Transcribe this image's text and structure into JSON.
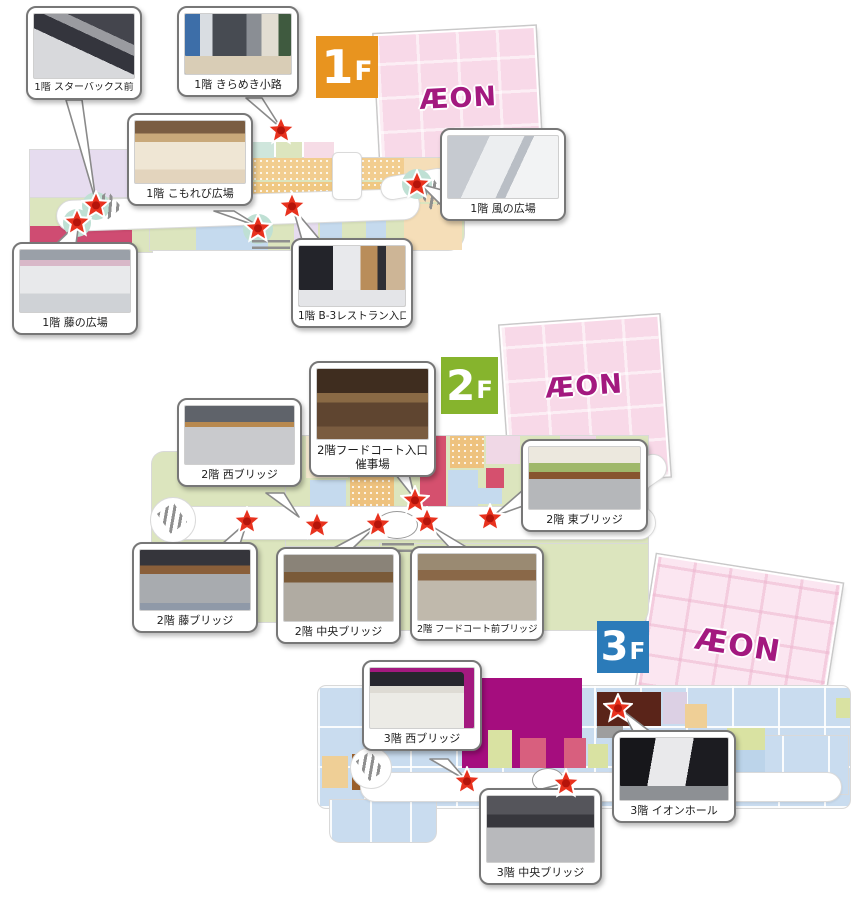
{
  "floors": [
    {
      "name": "1F",
      "badge": {
        "number": "1",
        "suffix": "F"
      },
      "aeon_logo": "ÆON",
      "callouts": [
        {
          "id": "starbucks",
          "label": "1階 スターバックス前"
        },
        {
          "id": "kirameki",
          "label": "1階 きらめき小路"
        },
        {
          "id": "komorebi",
          "label": "1階 こもれび広場"
        },
        {
          "id": "kaze",
          "label": "1階 風の広場"
        },
        {
          "id": "fuji",
          "label": "1階 藤の広場"
        },
        {
          "id": "b3",
          "label": "1階 B-3レストラン入口"
        }
      ]
    },
    {
      "name": "2F",
      "badge": {
        "number": "2",
        "suffix": "F"
      },
      "aeon_logo": "ÆON",
      "callouts": [
        {
          "id": "nishi",
          "label": "2階 西ブリッジ"
        },
        {
          "id": "foodcourt_entrance",
          "label": "2階フードコート入口催事場"
        },
        {
          "id": "higashi",
          "label": "2階 東ブリッジ"
        },
        {
          "id": "fuji_bridge",
          "label": "2階 藤ブリッジ"
        },
        {
          "id": "chuo",
          "label": "2階 中央ブリッジ"
        },
        {
          "id": "foodcourt_front",
          "label": "2階 フードコート前ブリッジ"
        }
      ]
    },
    {
      "name": "3F",
      "badge": {
        "number": "3",
        "suffix": "F"
      },
      "aeon_logo": "ÆON",
      "callouts": [
        {
          "id": "nishi",
          "label": "3階 西ブリッジ"
        },
        {
          "id": "hall",
          "label": "3階 イオンホール"
        },
        {
          "id": "chuo",
          "label": "3階 中央ブリッジ"
        }
      ]
    }
  ],
  "colors": {
    "badge_1f": "#e8941f",
    "badge_2f": "#86b42d",
    "badge_3f": "#2b7bb9",
    "aeon_magenta": "#a3197f",
    "aeon_building_pink": "#f8d9e8",
    "star_red": "#e8321e",
    "map_green": "#dce5be",
    "map_lavender": "#e6dcef",
    "map_orange": "#f2cd8f",
    "map_blue": "#c5daee",
    "map_crimson": "#d25a78",
    "map_blue_3f": "#c9dcef",
    "cinema_magenta": "#a50d7e",
    "hall_dark_brown": "#5a2419",
    "escalator_circle_teal": "#bfe0d4"
  }
}
